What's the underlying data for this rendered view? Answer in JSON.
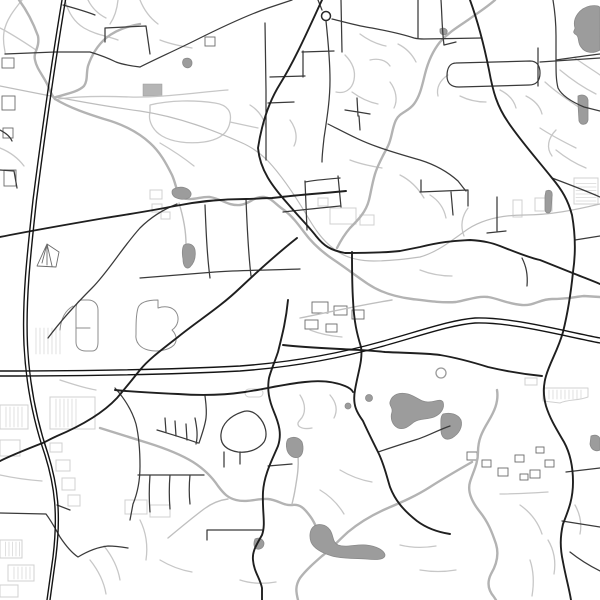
{
  "map": {
    "kind": "minimal-street-map",
    "background": "#ffffff",
    "width": 600,
    "height": 600,
    "palette": {
      "motorway": "#141414",
      "major_road": "#1f1f1f",
      "secondary_road": "#3a3a3a",
      "minor_road": "#c7c7c7",
      "railway": "#bdbdbd",
      "river": "#b3b3b3",
      "water_fill": "#9c9c9c",
      "building_outline": "#d0d0d0"
    },
    "layers": [
      {
        "name": "minor-roads",
        "cls": "road-minor",
        "paths": [
          "M22,0 C14,10 6,20 4,32 C2,44 6,52 5,54",
          "M65,0 C68,12 74,22 84,28 C96,35 108,36 118,40",
          "M88,0 C92,8 98,14 106,18",
          "M118,0 C117,10 114,18 110,24",
          "M0,28 C12,34 24,42 36,50",
          "M58,99 C80,96 105,96 130,97 C160,98 200,92 228,90",
          "M150,105 C170,100 195,100 215,103 C228,105 232,112 230,122 C228,134 218,140 204,142 C188,144 172,142 162,136 C152,130 148,120 150,112 Z",
          "M230,122 L258,128",
          "M160,143 C172,150 184,158 194,166",
          "M0,148 C10,152 18,158 24,166",
          "M140,0 C144,10 150,18 158,24",
          "M160,40 C170,44 180,46 192,48",
          "M345,55 C352,62 356,70 354,80 C352,90 344,94 336,92",
          "M370,60 C378,58 386,60 390,66",
          "M352,92 C360,98 368,102 378,104",
          "M390,82 C396,90 398,100 394,108",
          "M360,34 C368,40 376,44 386,46",
          "M398,44 C406,48 412,54 416,62",
          "M290,120 C296,128 298,138 294,146",
          "M250,105 C258,110 264,118 266,128",
          "M350,160 C360,164 370,166 382,168",
          "M400,175 C410,180 418,188 424,198",
          "M448,75 C440,80 436,88 438,96",
          "M460,96 C468,100 476,102 486,102",
          "M500,90 C508,94 514,100 516,108",
          "M526,96 C534,100 540,106 542,114",
          "M545,82 C556,92 568,100 580,108",
          "M560,70 C572,80 584,88 596,94",
          "M575,58 C586,66 596,72 600,75",
          "M540,128 C552,136 564,142 576,148",
          "M556,150 C566,158 576,164 586,168",
          "M556,130 C548,138 546,148 552,156",
          "M430,195 C438,200 444,208 446,218",
          "M468,208 C462,216 460,226 464,236",
          "M420,270 C430,274 440,276 452,276",
          "M310,330 C320,334 330,336 342,337",
          "M60,380 C72,384 84,388 96,390",
          "M0,475 C14,478 28,480 42,481",
          "M104,546 C112,556 118,568 120,580",
          "M90,560 C98,570 104,582 106,594",
          "M140,520 C146,532 148,546 146,560",
          "M160,560 C170,566 180,570 192,572",
          "M240,580 C252,584 264,584 276,582",
          "M340,470 C350,476 360,480 372,482",
          "M320,490 C330,496 338,504 344,514",
          "M400,545 C412,548 424,548 436,546",
          "M420,570 C432,572 444,572 456,570",
          "M520,505 C530,512 538,522 542,534",
          "M500,494 C516,494 532,493 548,492",
          "M530,560 C534,572 534,584 532,596",
          "M548,540 C554,550 556,562 554,574",
          "M575,505 C580,514 582,524 580,534",
          "M300,395 C306,404 306,414 300,420 C294,426 302,430 312,428",
          "M330,395 C336,402 338,410 334,418"
        ]
      },
      {
        "name": "railway",
        "cls": "railway",
        "paths": [
          "M0,86 C45,95 95,105 140,111 C180,117 215,131 240,142 C252,147 260,153 268,161 C282,176 294,194 306,214 C314,228 322,240 334,249 C344,257 358,261 374,261 C390,261 406,259 420,257 C438,252 452,240 468,229 C485,218 505,215 525,215 C550,215 575,210 600,204"
        ]
      },
      {
        "name": "rivers",
        "cls": "river",
        "paths": [
          "M19,0 C28,12 34,25 38,36 C40,48 33,52 35,60 C37,70 44,76 49,88 C51,93 52,96 55,99",
          "M140,24 C128,26 116,30 106,38 C98,45 92,54 88,66 C86,74 88,80 84,86 C78,92 66,94 56,97",
          "M55,99 C70,108 88,114 104,119 C122,124 138,132 150,143 C160,152 166,163 172,175 C176,184 176,190 180,197 C192,202 200,196 210,197 C222,199 228,206 240,205 C250,204 254,196 264,197 C272,198 276,205 284,210 C292,216 298,224 304,232 C312,243 322,252 334,260 C346,268 356,276 368,284 C380,292 396,297 412,299 C428,301 442,303 456,302 C468,300 476,296 488,297 C500,299 508,304 522,305 C534,306 540,299 552,299 C566,299 574,297 584,296 L600,297",
          "M495,0 C486,8 476,14 468,20 C456,28 448,33 440,42 C432,52 428,62 425,74 C422,86 420,96 414,104 C408,112 400,112 396,120 C392,128 392,138 388,146 C383,156 378,164 375,174 C372,184 371,192 369,200 C366,212 358,220 350,228 C344,235 340,242 337,248",
          "M497,390 C499,402 494,412 488,422 C482,432 478,440 478,452 C478,464 473,472 470,482 C467,492 472,502 480,512 C488,522 492,532 496,544 C499,554 497,564 491,574 C487,582 488,590 494,597 L496,600",
          "M472,462 C458,470 444,478 430,487 C416,496 402,502 388,508 C374,514 360,522 348,532 C338,541 330,550 322,556 C314,563 306,570 300,578 C295,586 296,592 298,600",
          "M100,428 C116,433 132,438 148,443 C164,448 180,454 193,462 C204,469 212,477 218,486 C224,494 228,498 236,500 C248,503 258,498 268,499 C278,500 284,506 292,505 C300,504 304,508 310,516 C316,524 319,534 322,545"
        ]
      },
      {
        "name": "streams",
        "cls": "stream",
        "paths": [
          "M179,203 C183,216 186,230 186,244",
          "M168,538 C180,528 192,518 204,509 C212,503 220,500 228,499",
          "M298,456 C299,468 297,478 295,490 C294,496 293,500 292,504",
          "M300,318 C330,312 360,305 392,300"
        ]
      },
      {
        "name": "park-outlines",
        "cls": "park-outline",
        "paths": [
          "M138,308 C140,302 148,300 158,300 L158,308 C164,306 172,306 176,312 C180,318 178,326 172,330 C176,334 178,340 174,345 C168,351 156,352 148,350 C140,348 135,342 136,334 C136,324 136,315 138,308 Z",
          "M82,300 C78,300 76,304 76,310 L76,342 C76,348 80,351 86,351 L92,351 C96,351 98,348 98,342 L98,310 C98,304 94,300 88,300 Z",
          "M76,328 L90,328",
          "M73,306 C66,310 61,318 60,330"
        ]
      },
      {
        "name": "lakes",
        "cls": "water",
        "paths": [
          "M575,28 C572,18 580,8 590,6 C596,5 600,6 600,8 L600,50 C593,54 585,53 581,47 C577,42 580,36 575,34 C572,32 575,30 575,28 Z",
          "M184,245 C189,242 194,245 195,250 C196,257 194,263 190,267 C186,270 183,266 183,259 C182,254 182,248 184,245 Z",
          "M176,188 C182,186 189,188 191,193 C192,198 186,200 180,199 C175,198 172,196 172,192 C172,189 174,189 176,188 Z",
          "M390,402 C392,394 400,392 408,394 C416,396 420,402 428,402 C436,402 440,398 443,402 C445,408 441,414 434,417 C426,420 420,418 414,422 C408,427 404,430 398,428 C392,425 390,418 392,412 C393,407 389,406 390,402 Z",
          "M443,414 C450,412 458,414 461,420 C463,427 459,434 452,438 C446,441 441,438 441,430 C441,423 440,417 443,414 Z",
          "M313,527 C318,523 326,524 330,530 C334,536 332,542 338,545 C346,548 356,544 366,545 C376,546 384,550 385,555 C385,560 376,560 366,559 C354,558 342,559 332,556 C322,553 314,549 311,542 C309,536 310,530 313,527 Z",
          "M288,439 C293,436 299,437 302,442 C304,448 303,455 299,457 C294,459 289,456 287,450 C286,446 286,442 288,439 Z",
          "M255,539 C259,537 263,539 264,543 C264,547 261,550 257,549 C254,548 253,544 255,539 Z",
          "M546,191 C550,189 553,191 552,197 L551,210 C550,214 546,214 545,210 L545,196 Z",
          "M578,96 C582,94 587,95 588,100 L588,120 C587,125 581,126 579,121 L578,104 Z",
          "M184,59 C188,57 192,59 192,63 C192,67 188,69 185,67 C182,65 182,61 184,59 Z",
          "M440,29 C444,27 448,29 447,33 C445,36 441,35 440,32 Z",
          "M591,436 C596,434 600,436 600,440 L600,450 C596,452 591,450 590,444 Z"
        ]
      },
      {
        "name": "secondary-roads",
        "cls": "road-sec",
        "paths": [
          "M48,338 C60,322 75,305 92,288 C108,272 122,248 140,228 C150,218 162,210 177,204",
          "M326,21 C328,40 330,60 330,80 C330,100 327,118 324,138 C323,148 322,155 322,162",
          "M332,19 C345,22 358,26 372,28 C388,31 402,34 414,38 C418,39 420,39 424,39 L482,38",
          "M318,0 L322,10",
          "M418,0 L418,38",
          "M441,0 C442,15 442,30 444,45",
          "M444,45 L456,42",
          "M265,23 L266,90 L266,160",
          "M140,67 C158,58 176,50 196,40 C220,28 245,16 268,8 L292,0",
          "M270,77 L305,76",
          "M302,52 L334,51",
          "M303,51 L303,77",
          "M268,103 L294,102",
          "M341,0 L342,52",
          "M283,212 C300,210 320,208 340,206",
          "M305,182 C315,180 328,179 340,178",
          "M338,176 L341,207",
          "M305,181 L307,230",
          "M328,124 C344,132 360,141 378,147 C392,152 406,156 420,160 C436,165 448,172 458,181 C462,186 464,189 466,191",
          "M421,180 L421,192 M420,192 L468,190 M468,190 L468,206 M451,192 L453,215 M497,197 L497,232 M487,233 L506,231",
          "M357,98 L358,116 M345,110 L358,112 M358,112 L370,114 M359,116 L360,130",
          "M553,0 C555,12 556,24 556,36 L556,60 C556,72 556,80 558,88 C562,96 572,102 584,107 L600,111",
          "M556,60 C570,58 584,56 600,54",
          "M456,63 L530,61 C537,61 540,66 540,73 C540,81 536,85 529,85 L459,87 C451,87 447,83 447,76 C447,68 450,63 456,63 Z",
          "M538,48 L538,86",
          "M540,62 L600,58",
          "M552,178 C568,184 584,190 600,197",
          "M575,240 L600,236",
          "M522,258 C526,266 528,274 527,286",
          "M205,205 C206,230 207,255 210,278",
          "M246,199 C247,225 248,250 251,276",
          "M140,278 C165,276 190,274 215,272 C245,270 275,270 300,269",
          "M0,170 L14,171 L17,188",
          "M0,130 C6,133 10,136 12,141",
          "M5,54 L55,52 L90,52 C100,55 108,58 116,62 C124,65 132,66 140,67",
          "M63,5 C74,8 85,11 95,15",
          "M105,42 L105,28 L146,26 L150,54",
          "M0,513 L46,514 C52,522 56,530 60,537 C66,546 72,553 78,557 C88,551 98,547 108,546 C115,546 122,547 128,548",
          "M57,505 L70,510",
          "M157,430 C170,434 184,438 198,443 M165,418 L166,432 M175,421 L176,436 M186,424 L187,440",
          "M205,396 C206,404 207,410 206,418 C205,426 202,434 199,443",
          "M195,418 C197,428 198,436 196,444",
          "M242,412 C230,416 222,424 221,434 C220,444 226,450 238,452 C248,453 258,450 264,442 C268,435 266,424 258,416 C253,411 247,410 242,412 Z",
          "M224,452 L224,467 M240,452 L240,464",
          "M138,475 L204,475 M150,475 C149,488 149,500 150,512 M170,475 C169,487 169,497 170,509 M190,475 C189,485 189,495 190,504",
          "M268,466 L292,464",
          "M207,530 L262,530 M207,530 L207,540",
          "M115,388 C124,398 132,410 136,424 C139,437 140,452 140,466 C140,480 138,492 133,504 L130,520",
          "M378,452 C390,448 402,444 415,440 C426,437 438,430 450,426",
          "M566,472 L600,468",
          "M562,521 L600,527",
          "M570,552 C580,560 590,566 600,571"
        ]
      },
      {
        "name": "major-roads",
        "cls": "road-major",
        "paths": [
          "M322,0 C309,28 295,60 280,84 C270,100 262,122 258,148 C260,170 272,186 288,204 C300,218 310,228 316,236 C324,246 330,250 345,253 C362,253 382,253 400,251 L420,247 C445,241 455,241 470,240 C485,241 492,243 500,246 C515,252 530,258 540,260 C555,266 565,270 575,274 C585,278 593,281 600,284",
          "M470,0 C478,22 484,45 489,70 C493,92 497,106 508,122 C520,140 536,158 552,178 C562,190 568,200 572,215 C575,232 576,252 573,272 C571,292 568,312 563,332 C558,350 550,362 546,376 C543,386 543,395 546,406 C550,419 557,430 564,442 C570,453 573,465 573,482 C573,500 568,511 563,524 C560,537 560,548 563,562 C566,578 569,588 571,600",
          "M297,238 C278,253 258,271 240,288 C219,308 199,320 178,337 C160,351 148,360 140,370 C131,381 124,390 117,398 C103,413 83,425 57,436 C48,440 44,443 40,444 C30,448 12,455 0,461",
          "M0,237 C35,230 70,224 105,218 C130,214 150,211 175,206 C200,201 225,199 246,199 C255,199 262,198 272,198 C290,196 300,195 312,194 C325,193 336,192 346,191",
          "M288,300 C286,320 283,332 278,352 C274,364 271,370 269,378 C267,390 269,400 274,412 C279,424 282,434 278,446 C272,460 264,475 263,492 C262,512 266,524 262,535 C257,544 252,551 253,560 C254,572 260,578 262,588 L262,600",
          "M283,345 C300,347 320,348 340,349 C355,350 370,350 385,352 C405,353 425,353 440,355 C458,358 472,362 488,367 C505,371 522,374 542,376",
          "M352,252 C352,268 352,284 353,300 C354,322 357,334 361,347 C363,360 358,372 355,390 C352,406 358,414 363,421 C367,430 372,440 378,452 C384,464 386,474 390,487 C395,500 403,510 417,521 C425,527 437,532 450,534",
          "M115,390 C135,392 155,393 178,394 C205,396 225,395 245,392 C265,389 285,384 305,382 C322,380 335,382 345,386 C350,388 352,390 353,392"
        ]
      },
      {
        "name": "motorways",
        "cls": "road-motorway",
        "paths": [
          "M62,0 C52,60 42,130 33,200 C27,255 22,300 24,345 C26,385 33,420 45,455 C55,487 58,515 53,557 L47,600",
          "M65.5,0 C55.5,60 45.5,130 36.5,200 C30.5,255 25.5,300 27.5,345 C29.5,385 36.5,420 48,454 C58,486 61,514 56,556 L50,600",
          "M0,371 C80,371 160,370 240,366 C280,363 330,356 380,342 C420,331 450,320 475,318 C510,317 555,329 600,338",
          "M0,376 C80,376 160,375 240,371 C280,368 330,361 380,347 C420,336 450,325 475,323 C510,322 555,334 600,343"
        ]
      }
    ],
    "buildings": {
      "light": [
        {
          "x": 150,
          "y": 190,
          "w": 12,
          "h": 9
        },
        {
          "x": 152,
          "y": 204,
          "w": 10,
          "h": 8
        },
        {
          "x": 161,
          "y": 212,
          "w": 9,
          "h": 7
        },
        {
          "x": 245,
          "y": 389,
          "w": 18,
          "h": 8,
          "rx": 4
        },
        {
          "x": 330,
          "y": 208,
          "w": 26,
          "h": 16
        },
        {
          "x": 360,
          "y": 215,
          "w": 14,
          "h": 10
        },
        {
          "x": 318,
          "y": 198,
          "w": 10,
          "h": 8
        },
        {
          "x": 513,
          "y": 200,
          "w": 9,
          "h": 17
        },
        {
          "x": 535,
          "y": 198,
          "w": 17,
          "h": 13
        },
        {
          "x": 574,
          "y": 178,
          "w": 24,
          "h": 26
        },
        {
          "x": 525,
          "y": 378,
          "w": 12,
          "h": 7
        },
        {
          "x": 50,
          "y": 397,
          "w": 45,
          "h": 32
        },
        {
          "x": 0,
          "y": 405,
          "w": 28,
          "h": 24
        },
        {
          "x": 0,
          "y": 440,
          "w": 20,
          "h": 16
        },
        {
          "x": 50,
          "y": 443,
          "w": 12,
          "h": 9
        },
        {
          "x": 56,
          "y": 460,
          "w": 14,
          "h": 11
        },
        {
          "x": 62,
          "y": 478,
          "w": 13,
          "h": 12
        },
        {
          "x": 68,
          "y": 495,
          "w": 12,
          "h": 11
        },
        {
          "x": 125,
          "y": 500,
          "w": 22,
          "h": 14
        },
        {
          "x": 150,
          "y": 505,
          "w": 20,
          "h": 12
        },
        {
          "x": 0,
          "y": 540,
          "w": 22,
          "h": 18
        },
        {
          "x": 8,
          "y": 565,
          "w": 26,
          "h": 16
        },
        {
          "x": 0,
          "y": 585,
          "w": 18,
          "h": 12
        }
      ],
      "dark": [
        {
          "x": 2,
          "y": 58,
          "w": 12,
          "h": 10
        },
        {
          "x": 2,
          "y": 96,
          "w": 13,
          "h": 14
        },
        {
          "x": 3,
          "y": 128,
          "w": 10,
          "h": 10
        },
        {
          "x": 4,
          "y": 170,
          "w": 12,
          "h": 16
        },
        {
          "x": 205,
          "y": 37,
          "w": 10,
          "h": 9
        },
        {
          "x": 312,
          "y": 302,
          "w": 16,
          "h": 11
        },
        {
          "x": 334,
          "y": 306,
          "w": 13,
          "h": 9
        },
        {
          "x": 352,
          "y": 310,
          "w": 12,
          "h": 9
        },
        {
          "x": 305,
          "y": 320,
          "w": 13,
          "h": 9
        },
        {
          "x": 326,
          "y": 324,
          "w": 11,
          "h": 8
        },
        {
          "x": 467,
          "y": 452,
          "w": 10,
          "h": 8
        },
        {
          "x": 482,
          "y": 460,
          "w": 9,
          "h": 7
        },
        {
          "x": 498,
          "y": 468,
          "w": 10,
          "h": 8
        },
        {
          "x": 515,
          "y": 455,
          "w": 9,
          "h": 7
        },
        {
          "x": 530,
          "y": 470,
          "w": 10,
          "h": 8
        },
        {
          "x": 545,
          "y": 460,
          "w": 9,
          "h": 7
        },
        {
          "x": 520,
          "y": 474,
          "w": 8,
          "h": 6
        },
        {
          "x": 536,
          "y": 447,
          "w": 8,
          "h": 6
        }
      ],
      "filled": [
        {
          "x": 143,
          "y": 84,
          "w": 19,
          "h": 12
        }
      ],
      "polygons": [
        {
          "cls": "bldg",
          "d": "M543,388 L588,388 L588,397 C578,401 568,399 560,403 L543,401 Z"
        },
        {
          "cls": "bldg-dark",
          "d": "M37,266 L47,244 L59,252 L56,267 Z M47,244 L42,263 M47,244 L47,265 M47,244 L52,266"
        }
      ],
      "hatches": [
        {
          "x": 52,
          "y": 399,
          "w": 26,
          "h": 28,
          "step": 4,
          "dir": "v"
        },
        {
          "x": 2,
          "y": 407,
          "w": 24,
          "h": 20,
          "step": 4,
          "dir": "v"
        },
        {
          "x": 32,
          "y": 328,
          "w": 30,
          "h": 26,
          "step": 4,
          "dir": "v"
        },
        {
          "x": 2,
          "y": 542,
          "w": 18,
          "h": 14,
          "step": 3.5,
          "dir": "v"
        },
        {
          "x": 10,
          "y": 567,
          "w": 22,
          "h": 12,
          "step": 4,
          "dir": "v"
        },
        {
          "x": 576,
          "y": 180,
          "w": 20,
          "h": 22,
          "step": 3.5,
          "dir": "h"
        },
        {
          "x": 545,
          "y": 390,
          "w": 40,
          "h": 9,
          "step": 4,
          "dir": "v"
        }
      ]
    },
    "circles": [
      {
        "name": "roundabout-main",
        "cls": "ra-major",
        "cx": 326,
        "cy": 16,
        "r": 4.5
      },
      {
        "name": "roundabout-subdivision",
        "cls": "ra-minor",
        "cx": 441,
        "cy": 373,
        "r": 5
      },
      {
        "name": "pond-dot-1",
        "cls": "water",
        "cx": 348,
        "cy": 406,
        "r": 3
      },
      {
        "name": "pond-dot-2",
        "cls": "water",
        "cx": 369,
        "cy": 398,
        "r": 3.5
      }
    ]
  }
}
